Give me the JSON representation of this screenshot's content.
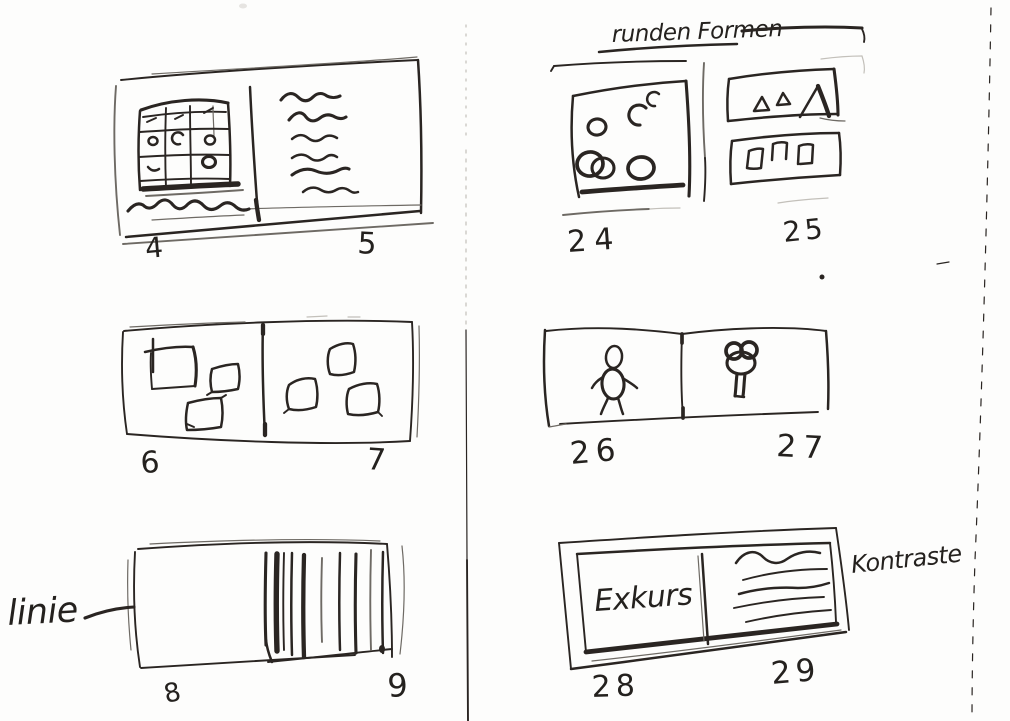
{
  "sheet": {
    "paper_color": "#fdfdfc",
    "ink_color": "#2a2522",
    "pencil_color": "#6e6a64"
  },
  "annotations": {
    "round_forms": "runden Formen",
    "line": "linie",
    "contrasts": "Kontraste"
  },
  "spreads": {
    "s45": {
      "left_num": "4",
      "right_num": "5"
    },
    "s67": {
      "left_num": "6",
      "right_num": "7"
    },
    "s89": {
      "left_num": "8",
      "right_num": "9"
    },
    "s2425": {
      "left_num": "24",
      "right_num": "25"
    },
    "s2627": {
      "left_num": "26",
      "right_num": "27"
    },
    "s2829": {
      "left_num": "28",
      "right_num": "29",
      "excursus_label": "Exkurs"
    }
  }
}
